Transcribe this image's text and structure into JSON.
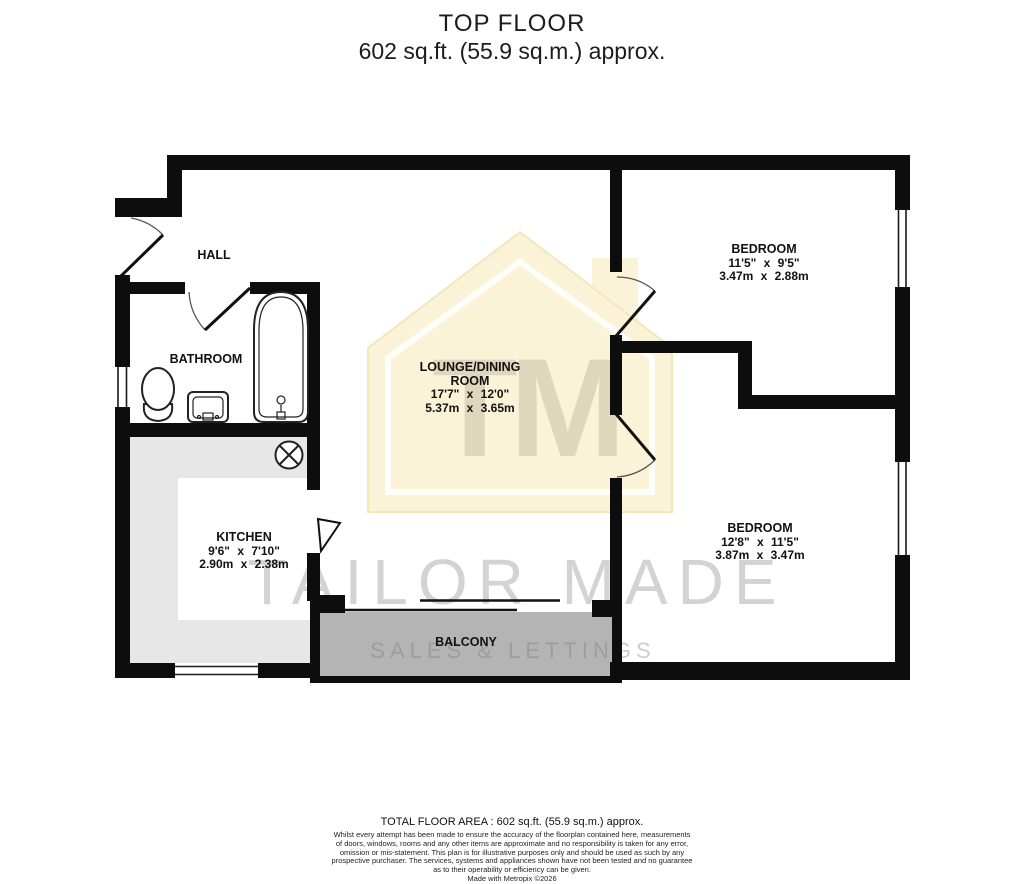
{
  "title": {
    "line1": "TOP FLOOR",
    "line2": "602 sq.ft. (55.9 sq.m.) approx."
  },
  "watermark": {
    "monogram": "TM",
    "name": "TAILOR MADE",
    "tagline": "SALES & LETTINGS"
  },
  "rooms": {
    "hall": {
      "name": "HALL"
    },
    "bathroom": {
      "name": "BATHROOM"
    },
    "kitchen": {
      "name": "KITCHEN",
      "imperial": "9'6\" x 7'10\"",
      "metric": "2.90m x 2.38m"
    },
    "lounge": {
      "name_line1": "LOUNGE/DINING",
      "name_line2": "ROOM",
      "imperial": "17'7\" x 12'0\"",
      "metric": "5.37m x 3.65m"
    },
    "bedroom1": {
      "name": "BEDROOM",
      "imperial": "11'5\" x 9'5\"",
      "metric": "3.47m x 2.88m"
    },
    "bedroom2": {
      "name": "BEDROOM",
      "imperial": "12'8\" x 11'5\"",
      "metric": "3.87m x 3.47m"
    },
    "balcony": {
      "name": "BALCONY"
    }
  },
  "footer": {
    "total_area": "TOTAL FLOOR AREA : 602 sq.ft. (55.9 sq.m.) approx.",
    "disclaimer_lines": [
      "Whilst every attempt has been made to ensure the accuracy of the floorplan contained here, measurements",
      "of doors, windows, rooms and any other items are approximate and no responsibility is taken for any error,",
      "omission or mis-statement. This plan is for illustrative purposes only and should be used as such by any",
      "prospective purchaser. The services, systems and appliances shown have not been tested and no guarantee",
      "as to their operability or efficiency can be given.",
      "Made with Metropix ©2026"
    ]
  },
  "colors": {
    "wall": "#0d0d0d",
    "kitchen_counter": "#e7e7e7",
    "balcony": "#b4b4b4",
    "watermark_house": "#fbf3d7"
  }
}
